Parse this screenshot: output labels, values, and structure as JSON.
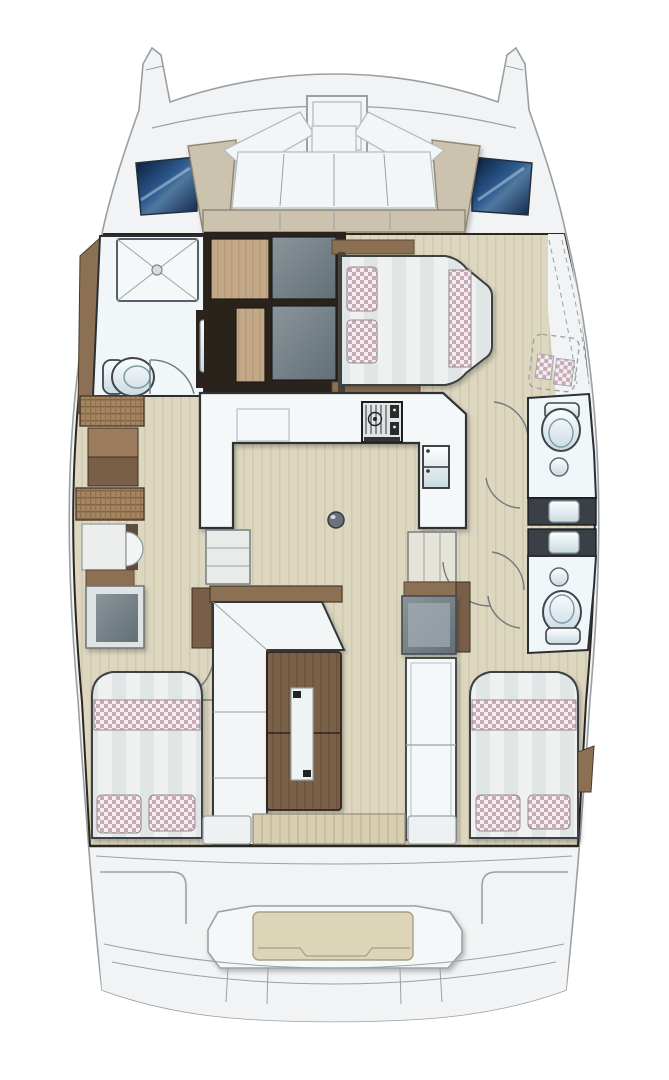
{
  "page": {
    "title": "Catamaran interior layout — top-down floor plan"
  },
  "colors": {
    "bg": "#ffffff",
    "deck": "#f1f3f4",
    "deck_line": "#9aa1a5",
    "dark_line": "#2b2620",
    "window_navy": "#0a1a33",
    "window_navy_mid": "#2c5a8f",
    "window_navy_deep": "#0f2647",
    "seat_taupe": "#cbc3ae",
    "cushion_white": "#f3f6f6",
    "floor_beige": "#ddd7c0",
    "floor_stripe": "#d0cab2",
    "wood_dark": "#7a5f48",
    "wood_dark_stripe": "#6d543e",
    "wood_mid": "#8b7054",
    "wood_light": "#c3a988",
    "wood_light_stripe": "#b79b79",
    "panel_gray_light": "#8a959b",
    "panel_gray_dark": "#626f76",
    "frame_dark": "#29231c",
    "room_white": "#f1f6f8",
    "counter_white": "#f5f8f9",
    "bed_white": "#eef1f0",
    "bed_stripe": "#e0e6e5",
    "pillow_pink": "#c9a9b6",
    "pillow_base": "#f3eff1",
    "fixture_hi": "#fdfefe",
    "fixture_lo": "#c9dae2",
    "woven_tan": "#a58460",
    "woven_line": "#7e6348",
    "teak": "#d8cfb2",
    "teak_stripe": "#c8bf9f",
    "vanity_dark": "#3a4045"
  },
  "vessel": {
    "type": "catamaran",
    "view": "top-down interior layout plan",
    "areas": [
      {
        "id": "bow-pods"
      },
      {
        "id": "foredeck"
      },
      {
        "id": "deck-hatch"
      },
      {
        "id": "bow-lounge"
      },
      {
        "id": "port-hull-window"
      },
      {
        "id": "starboard-hull-window"
      },
      {
        "id": "port-forward-head"
      },
      {
        "id": "wardrobe-cabinets"
      },
      {
        "id": "forward-cabin"
      },
      {
        "id": "galley"
      },
      {
        "id": "saloon"
      },
      {
        "id": "port-hull-passage"
      },
      {
        "id": "starboard-hull-passage"
      },
      {
        "id": "starboard-forward-head"
      },
      {
        "id": "starboard-aft-head"
      },
      {
        "id": "port-aft-cabin"
      },
      {
        "id": "starboard-aft-cabin"
      },
      {
        "id": "cockpit"
      },
      {
        "id": "transom-bench"
      }
    ]
  }
}
